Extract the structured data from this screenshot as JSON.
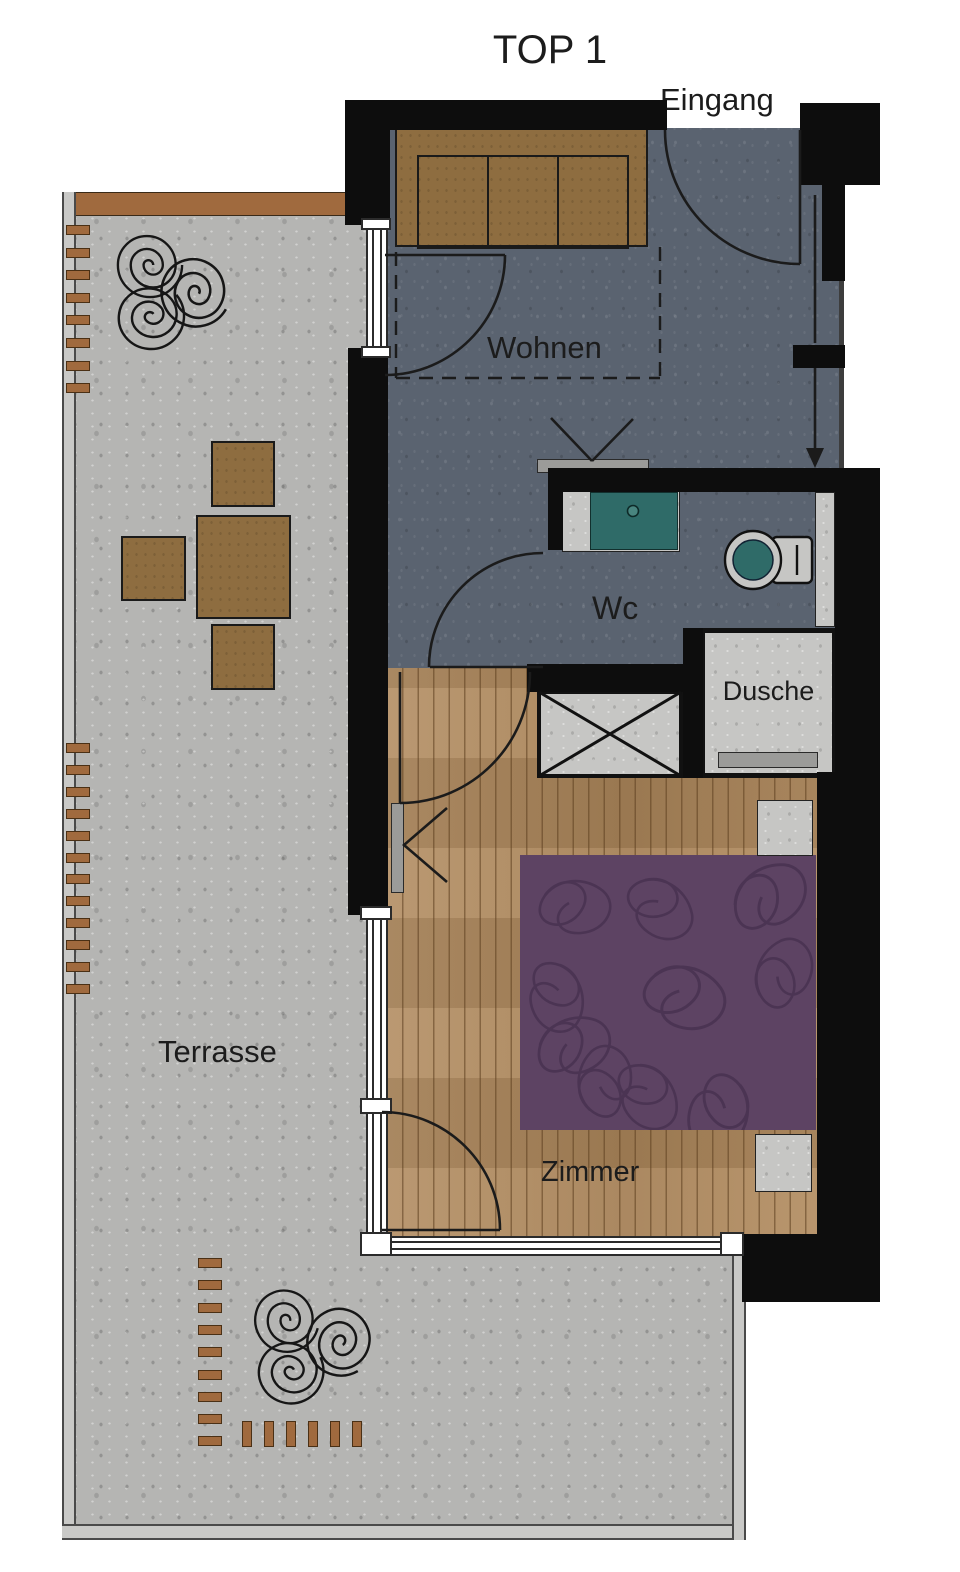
{
  "title": "TOP 1",
  "labels": {
    "entrance": "Eingang",
    "living_room": "Wohnen",
    "wc": "Wc",
    "shower": "Dusche",
    "bedroom": "Zimmer",
    "terrace": "Terrasse"
  },
  "colors": {
    "wall": "#0d0d0d",
    "living_floor": "#5a6370",
    "wood_floor": "#b0895c",
    "terrace_concrete": "#b5b5b3",
    "light_concrete": "#c6c6c4",
    "furniture_brown": "#8e6d40",
    "deco_brown": "#a06a3e",
    "bed_purple": "#5d4363",
    "fixture_teal": "#2f6b68",
    "window_white": "#ffffff"
  },
  "icons": {
    "door_swing": "quarter-arc",
    "entry_direction": "down-arrow",
    "tv": "v-antenna-on-bar",
    "shaft": "crossed-box",
    "plants": "triple-spiral",
    "radiator": "left-chevron-bar"
  }
}
